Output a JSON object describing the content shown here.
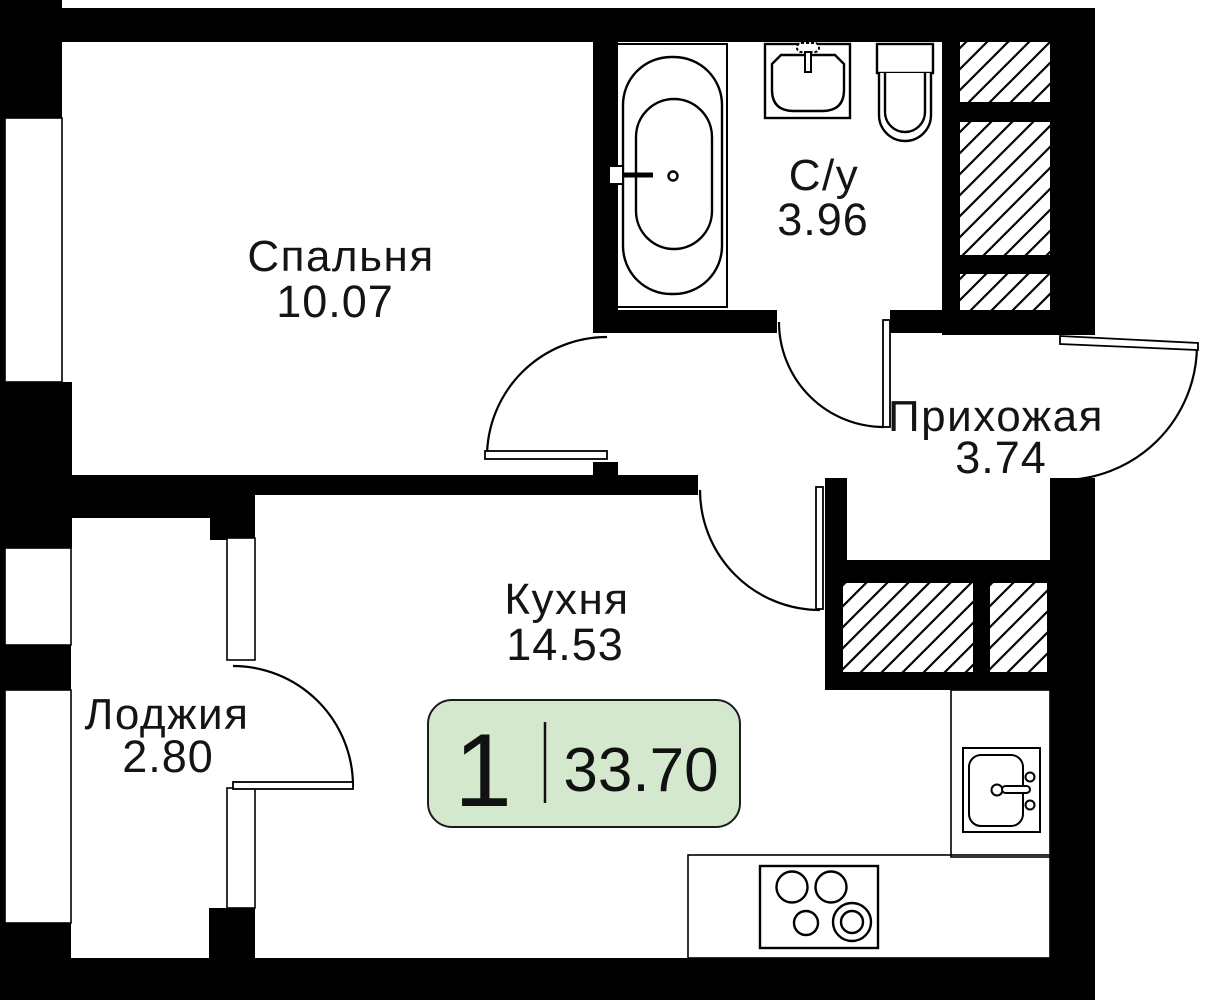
{
  "badge": {
    "rooms": "1",
    "area": "33.70"
  },
  "rooms": [
    {
      "id": "bedroom",
      "label": "Спальня",
      "area": "10.07"
    },
    {
      "id": "bathroom",
      "label": "С/у",
      "area": "3.96"
    },
    {
      "id": "hallway",
      "label": "Прихожая",
      "area": "3.74"
    },
    {
      "id": "kitchen",
      "label": "Кухня",
      "area": "14.53"
    },
    {
      "id": "loggia",
      "label": "Лоджия",
      "area": "2.80"
    }
  ],
  "fixtures": [
    "bathtub",
    "washbasin",
    "toilet",
    "kitchen-sink",
    "stove",
    "ventilation-shaft"
  ],
  "colors": {
    "wall": "#000000",
    "background": "#ffffff",
    "badge_fill": "#d3e8cc",
    "badge_border": "#1c1c1c",
    "text": "#141414"
  }
}
